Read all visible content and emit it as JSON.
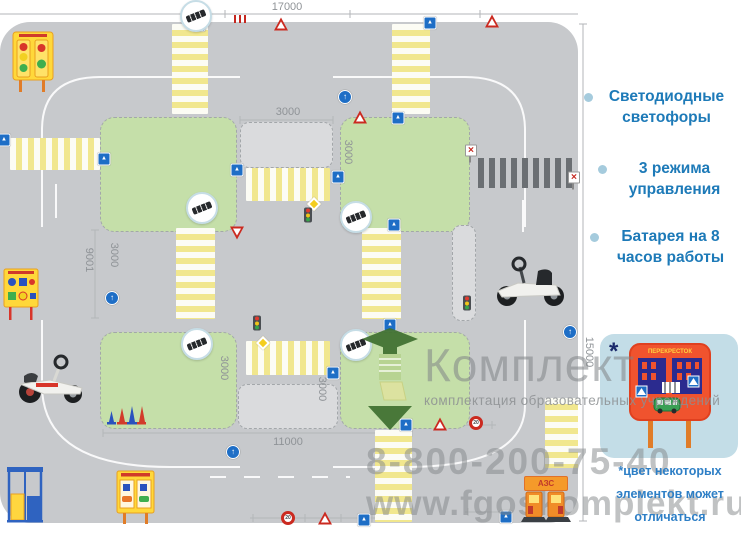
{
  "plan": {
    "dim_labels": [
      {
        "t": "17000",
        "x": 287,
        "y": 1,
        "o": "h"
      },
      {
        "t": "3000",
        "x": 288,
        "y": 106,
        "o": "h"
      },
      {
        "t": "3000",
        "x": 348,
        "y": 152,
        "o": "v"
      },
      {
        "t": "3000",
        "x": 114,
        "y": 255,
        "o": "v"
      },
      {
        "t": "3000",
        "x": 224,
        "y": 368,
        "o": "v"
      },
      {
        "t": "3000",
        "x": 322,
        "y": 389,
        "o": "v"
      },
      {
        "t": "9001",
        "x": 89,
        "y": 260,
        "o": "v"
      },
      {
        "t": "11000",
        "x": 288,
        "y": 436,
        "o": "h"
      },
      {
        "t": "15000",
        "x": 589,
        "y": 352,
        "o": "v"
      }
    ],
    "blocks": [
      {
        "kind": "green",
        "x": 100,
        "y": 117,
        "w": 137,
        "h": 115
      },
      {
        "kind": "green",
        "x": 340,
        "y": 117,
        "w": 130,
        "h": 115
      },
      {
        "kind": "green",
        "x": 100,
        "y": 332,
        "w": 137,
        "h": 97
      },
      {
        "kind": "green",
        "x": 340,
        "y": 332,
        "w": 130,
        "h": 97
      },
      {
        "kind": "plot",
        "x": 240,
        "y": 122,
        "w": 93,
        "h": 46
      },
      {
        "kind": "plot",
        "x": 238,
        "y": 384,
        "w": 100,
        "h": 45
      },
      {
        "kind": "plot",
        "x": 452,
        "y": 225,
        "w": 24,
        "h": 96
      }
    ],
    "zebras": [
      {
        "x": 172,
        "y": 24,
        "w": 36,
        "h": 90,
        "ax": "y"
      },
      {
        "x": 392,
        "y": 24,
        "w": 38,
        "h": 90,
        "ax": "y"
      },
      {
        "x": 10,
        "y": 138,
        "w": 90,
        "h": 32,
        "ax": "x"
      },
      {
        "x": 246,
        "y": 168,
        "w": 84,
        "h": 33,
        "ax": "x"
      },
      {
        "x": 176,
        "y": 228,
        "w": 39,
        "h": 91,
        "ax": "y"
      },
      {
        "x": 362,
        "y": 228,
        "w": 39,
        "h": 91,
        "ax": "y"
      },
      {
        "x": 246,
        "y": 341,
        "w": 84,
        "h": 34,
        "ax": "x"
      },
      {
        "x": 375,
        "y": 430,
        "w": 37,
        "h": 92,
        "ax": "y"
      },
      {
        "x": 545,
        "y": 398,
        "w": 33,
        "h": 70,
        "ax": "y"
      }
    ],
    "railroad": {
      "x": 478,
      "y": 158,
      "w": 94,
      "h": 30
    },
    "markers": [
      {
        "type": "callout-speed-bump",
        "x": 196,
        "y": 16
      },
      {
        "type": "callout-speed-bump",
        "x": 202,
        "y": 208
      },
      {
        "type": "callout-speed-bump",
        "x": 356,
        "y": 217
      },
      {
        "type": "callout-speed-bump",
        "x": 197,
        "y": 344
      },
      {
        "type": "callout-speed-bump",
        "x": 356,
        "y": 345
      },
      {
        "type": "sign-blue-square",
        "x": 199,
        "y": 25,
        "g": "▲"
      },
      {
        "type": "sign-blue-square",
        "x": 430,
        "y": 23,
        "g": "▲"
      },
      {
        "type": "sign-blue-square",
        "x": 398,
        "y": 118,
        "g": "▲"
      },
      {
        "type": "sign-blue-square",
        "x": 237,
        "y": 170,
        "g": "▲"
      },
      {
        "type": "sign-blue-square",
        "x": 338,
        "y": 177,
        "g": "▲"
      },
      {
        "type": "sign-blue-square",
        "x": 394,
        "y": 225,
        "g": "▲"
      },
      {
        "type": "sign-blue-square",
        "x": 4,
        "y": 140,
        "g": "▲"
      },
      {
        "type": "sign-blue-square",
        "x": 104,
        "y": 159,
        "g": "▲"
      },
      {
        "type": "sign-blue-square",
        "x": 390,
        "y": 325,
        "g": "▲"
      },
      {
        "type": "sign-blue-square",
        "x": 333,
        "y": 373,
        "g": "▲"
      },
      {
        "type": "sign-blue-square",
        "x": 406,
        "y": 425,
        "g": "▲"
      },
      {
        "type": "sign-blue-square",
        "x": 364,
        "y": 520,
        "g": "▲"
      },
      {
        "type": "sign-blue-square",
        "x": 506,
        "y": 517,
        "g": "▲"
      },
      {
        "type": "sign-blue-circle",
        "x": 345,
        "y": 97,
        "g": "↑"
      },
      {
        "type": "sign-blue-circle",
        "x": 112,
        "y": 298,
        "g": "↑"
      },
      {
        "type": "sign-blue-circle",
        "x": 233,
        "y": 452,
        "g": "↑"
      },
      {
        "type": "sign-blue-circle",
        "x": 570,
        "y": 332,
        "g": "↑"
      },
      {
        "type": "sign-red-triangle",
        "x": 281,
        "y": 24
      },
      {
        "type": "sign-red-triangle",
        "x": 492,
        "y": 21
      },
      {
        "type": "sign-red-triangle",
        "x": 360,
        "y": 117
      },
      {
        "type": "sign-red-triangle",
        "x": 440,
        "y": 424
      },
      {
        "type": "sign-red-triangle",
        "x": 325,
        "y": 518
      },
      {
        "type": "sign-yield-triangle",
        "x": 237,
        "y": 233
      },
      {
        "type": "sign-speed-limit",
        "x": 288,
        "y": 518,
        "g": "20"
      },
      {
        "type": "sign-speed-limit",
        "x": 476,
        "y": 423,
        "g": "20"
      },
      {
        "type": "sign-priority-diamond",
        "x": 314,
        "y": 204
      },
      {
        "type": "sign-priority-diamond",
        "x": 263,
        "y": 343
      },
      {
        "type": "traffic-light-small",
        "x": 308,
        "y": 215
      },
      {
        "type": "traffic-light-small",
        "x": 257,
        "y": 323
      },
      {
        "type": "traffic-light-small",
        "x": 467,
        "y": 303
      },
      {
        "type": "railway-signal",
        "x": 470,
        "y": 153,
        "g": "✕"
      },
      {
        "type": "railway-signal",
        "x": 573,
        "y": 180,
        "g": "✕"
      },
      {
        "type": "misc-red-marks",
        "x": 240,
        "y": 19
      }
    ],
    "equipment": {
      "azs_label": "АЗС"
    }
  },
  "sidebar": {
    "bullets": [
      {
        "label": "Светодиодные\nсветофоры"
      },
      {
        "label": "3 режима\nуправления"
      },
      {
        "label": "Батарея на 8\nчасов работы"
      }
    ],
    "card": {
      "asterisk": "*",
      "sign_title": "ПЕРЕКРЕСТОК"
    },
    "note": "*цвет некоторых\nэлементов может\nотличаться"
  },
  "watermark": {
    "brand": "Комплект",
    "tagline": "комплектация образовательных учреждений",
    "phone": "8-800-200-75-40",
    "site": "www.fgoskomplekt.ru"
  },
  "colors": {
    "field_grey": "#c7c9cc",
    "grass_green": "#c5dfa9",
    "zebra_yellow": "#f1e78e",
    "sign_blue": "#1e6ec6",
    "sign_red": "#cb2a20",
    "accent_blue": "#1d7ab8",
    "note_blue": "#2e7fc6",
    "card_bg": "#c3dde7",
    "sign_orange": "#f0532e",
    "watermark_grey": "#8c8f92"
  }
}
